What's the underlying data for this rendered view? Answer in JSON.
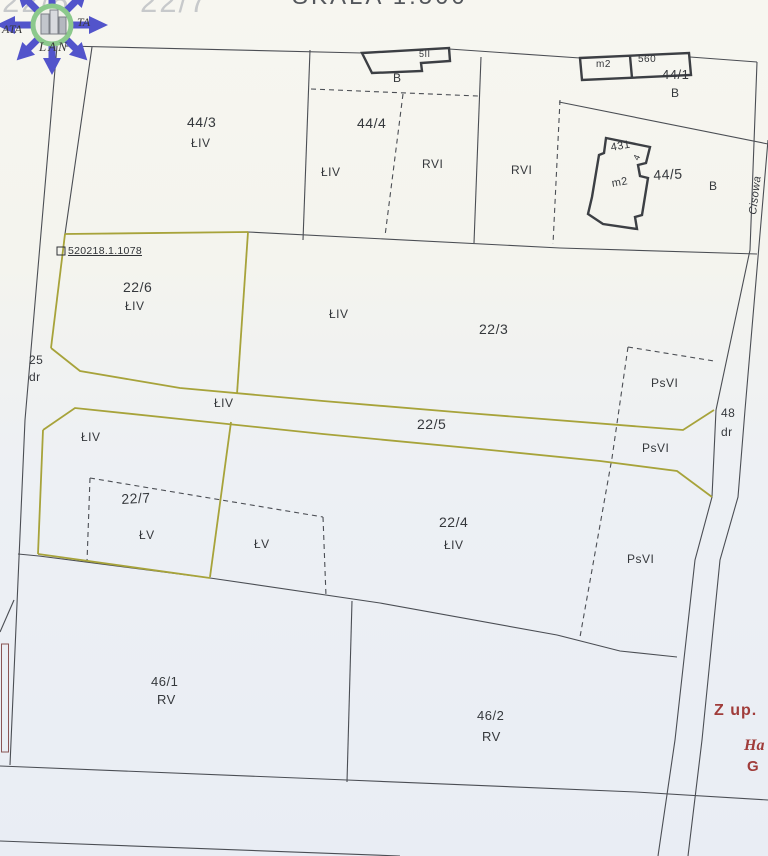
{
  "sheet": {
    "title_clipped": "SKALA 1:500",
    "ghost_watermark": {
      "left": "22/6",
      "right": "22/7"
    },
    "survey_point_id": "520218.1.1078"
  },
  "logo": {
    "text_left": "ATA",
    "text_right": "TA",
    "text_bottom": "LAN"
  },
  "labels": [
    {
      "text": "5II"
    },
    {
      "text": "B"
    },
    {
      "text": "44/3"
    },
    {
      "text": "ŁIV"
    },
    {
      "text": "44/4"
    },
    {
      "text": "ŁIV"
    },
    {
      "text": "RVI"
    },
    {
      "text": "RVI"
    },
    {
      "text": "m2"
    },
    {
      "text": "560"
    },
    {
      "text": "44/1"
    },
    {
      "text": "B"
    },
    {
      "text": "431"
    },
    {
      "text": "m2"
    },
    {
      "text": "4"
    },
    {
      "text": "44/5"
    },
    {
      "text": "B"
    },
    {
      "text": "Cisowa"
    },
    {
      "text": "22/6"
    },
    {
      "text": "ŁIV"
    },
    {
      "text": "ŁIV"
    },
    {
      "text": "22/3"
    },
    {
      "text": "25"
    },
    {
      "text": "dr"
    },
    {
      "text": "PsVI"
    },
    {
      "text": "48"
    },
    {
      "text": "dr"
    },
    {
      "text": "PsVI"
    },
    {
      "text": "ŁIV"
    },
    {
      "text": "22/5"
    },
    {
      "text": "ŁIV"
    },
    {
      "text": "22/7"
    },
    {
      "text": "ŁV"
    },
    {
      "text": "ŁV"
    },
    {
      "text": "22/4"
    },
    {
      "text": "ŁIV"
    },
    {
      "text": "PsVI"
    },
    {
      "text": "46/1"
    },
    {
      "text": "RV"
    },
    {
      "text": "46/2"
    },
    {
      "text": "RV"
    }
  ],
  "stamp": {
    "line1": "Z up.",
    "line2": "Ha",
    "line3": "G"
  },
  "colors": {
    "boundary_line": "#4b4e54",
    "highlight_olive": "#a7a33a",
    "building_outline": "#3c3f44",
    "stamp_red": "#a03c3a",
    "logo_blue": "#5254cb",
    "logo_green": "#8cc98c",
    "red_parcel_outline": "#8a5555"
  }
}
